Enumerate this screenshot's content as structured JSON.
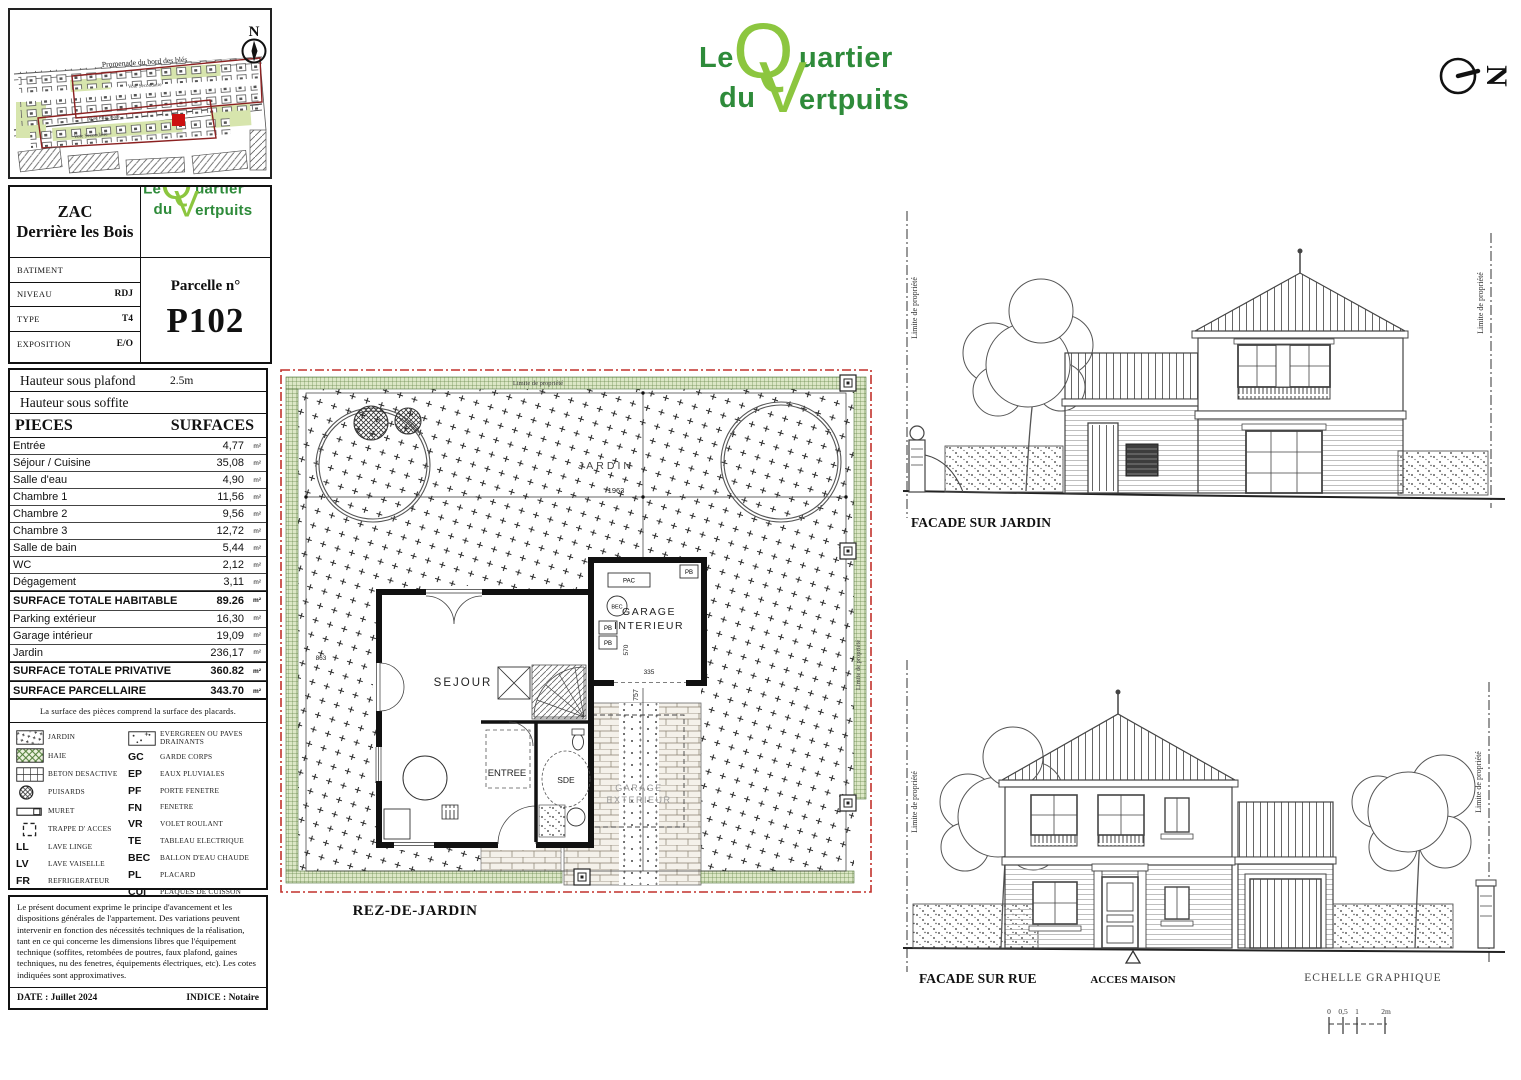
{
  "logo": {
    "le": "Le",
    "q": "Q",
    "uartier": "uartier",
    "du": "du",
    "v": "V",
    "ertpuits": "ertpuits",
    "color_light": "#8cc63f",
    "color_dark": "#2e8b3a"
  },
  "site_map": {
    "road_label": "Promenade du bord des blés",
    "street1": "Voie Secondaire",
    "street2": "Voie Principale",
    "street3": "Voie Secondaire",
    "compass": "N",
    "parcel_color": "#cc1111",
    "boundary_color": "#8b2020"
  },
  "north_arrow": {
    "letter": "N"
  },
  "title_block": {
    "project_line1": "ZAC",
    "project_line2": "Derrière les Bois",
    "rows": [
      {
        "label": "BATIMENT",
        "value": ""
      },
      {
        "label": "NIVEAU",
        "value": "RDJ"
      },
      {
        "label": "TYPE",
        "value": "T4"
      },
      {
        "label": "EXPOSITION",
        "value": "E/O"
      }
    ],
    "parcel_label": "Parcelle n°",
    "parcel_number": "P102"
  },
  "surfaces": {
    "hauteur_plafond_label": "Hauteur sous plafond",
    "hauteur_plafond_value": "2.5m",
    "hauteur_soffite_label": "Hauteur sous soffite",
    "col_pieces": "PIECES",
    "col_surfaces": "SURFACES",
    "unit": "m²",
    "rows": [
      {
        "name": "Entrée",
        "value": "4,77"
      },
      {
        "name": "Séjour / Cuisine",
        "value": "35,08"
      },
      {
        "name": "Salle d'eau",
        "value": "4,90"
      },
      {
        "name": "Chambre 1",
        "value": "11,56"
      },
      {
        "name": "Chambre 2",
        "value": "9,56"
      },
      {
        "name": "Chambre 3",
        "value": "12,72"
      },
      {
        "name": "Salle de bain",
        "value": "5,44"
      },
      {
        "name": "WC",
        "value": "2,12"
      },
      {
        "name": "Dégagement",
        "value": "3,11"
      },
      {
        "name": "SURFACE TOTALE HABITABLE",
        "value": "89.26",
        "bold": true
      },
      {
        "name": "Parking extérieur",
        "value": "16,30"
      },
      {
        "name": "Garage intérieur",
        "value": "19,09"
      },
      {
        "name": "Jardin",
        "value": "236,17"
      },
      {
        "name": "SURFACE TOTALE PRIVATIVE",
        "value": "360.82",
        "bold": true
      },
      {
        "name": "SURFACE PARCELLAIRE",
        "value": "343.70",
        "bold": true
      }
    ]
  },
  "legend": {
    "note": "La surface des pièces comprend la surface des placards.",
    "left": [
      {
        "swatch": "jardin",
        "label": "JARDIN"
      },
      {
        "swatch": "haie",
        "label": "HAIE"
      },
      {
        "swatch": "beton",
        "label": "BETON DESACTIVE"
      },
      {
        "swatch": "puisard",
        "label": "PUISARDS"
      },
      {
        "swatch": "muret",
        "label": "MURET"
      },
      {
        "swatch": "trappe",
        "label": "TRAPPE D' ACCES"
      },
      {
        "abbr": "LL",
        "label": "LAVE LINGE"
      },
      {
        "abbr": "LV",
        "label": "LAVE VAISELLE"
      },
      {
        "abbr": "FR",
        "label": "REFRIGERATEUR"
      }
    ],
    "right": [
      {
        "swatch": "evergreen",
        "label": "EVERGREEN OU PAVES DRAINANTS"
      },
      {
        "abbr": "GC",
        "label": "GARDE CORPS"
      },
      {
        "abbr": "EP",
        "label": "EAUX PLUVIALES"
      },
      {
        "abbr": "PF",
        "label": "PORTE FENETRE"
      },
      {
        "abbr": "FN",
        "label": "FENETRE"
      },
      {
        "abbr": "VR",
        "label": "VOLET ROULANT"
      },
      {
        "abbr": "TE",
        "label": "TABLEAU ELECTRIQUE"
      },
      {
        "abbr": "BEC",
        "label": "BALLON D'EAU CHAUDE"
      },
      {
        "abbr": "PL",
        "label": "PLACARD"
      },
      {
        "abbr": "CUI",
        "label": "PLAQUES DE CUISSON"
      }
    ]
  },
  "disclaimer": {
    "text": "Le présent document exprime le principe d'avancement et les dispositions générales de l'appartement. Des variations peuvent intervenir en fonction des nécessités techniques de la réalisation, tant en ce qui concerne les dimensions libres que l'équipement technique (soffites, retombées de poutres, faux plafond, gaines techniques, nu des fenetres, équipements électriques, etc). Les cotes indiquées sont approximatives.",
    "date": "DATE : Juillet 2024",
    "indice": "INDICE : Notaire"
  },
  "plan": {
    "caption": "REZ-DE-JARDIN",
    "labels": {
      "jardin": "JARDIN",
      "sejour": "SEJOUR",
      "entree": "ENTREE",
      "sde": "SDE",
      "garage_int_1": "GARAGE",
      "garage_int_2": "INTERIEUR",
      "garage_ext_1": "GARAGE",
      "garage_ext_2": "EXTERIEUR",
      "pac": "PAC",
      "bec": "BEC",
      "pb": "PB",
      "limite": "Limite de propriété"
    },
    "dims": {
      "top": "1963",
      "vertical": "757",
      "garage_w": "335",
      "garage_h": "570",
      "left": "863"
    }
  },
  "facade_jardin": {
    "title": "FACADE SUR JARDIN",
    "limite_left": "Limite de propriété",
    "limite_right": "Limite de propriété"
  },
  "facade_rue": {
    "title": "FACADE SUR RUE",
    "acces": "ACCES MAISON",
    "echelle": "ECHELLE GRAPHIQUE",
    "limite_left": "Limite de propriété",
    "limite_right": "Limite de propriété",
    "scale": {
      "m0": "0",
      "m05": "0,5",
      "m1": "1",
      "m2": "2m"
    }
  }
}
